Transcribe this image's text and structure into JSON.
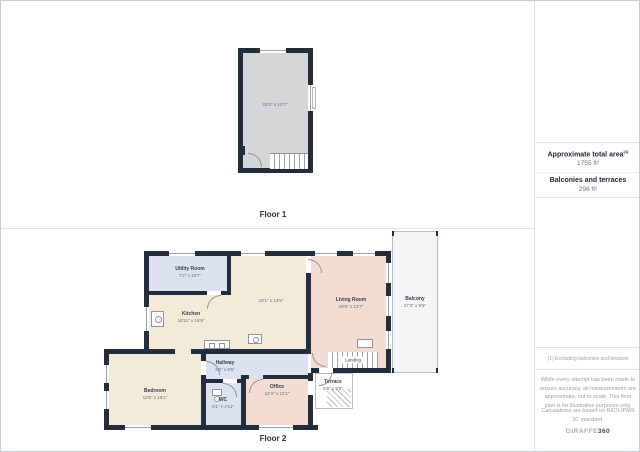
{
  "floor1": {
    "label": "Floor 1",
    "room_dims": "23'0\" x 12'7\""
  },
  "floor2": {
    "label": "Floor 2",
    "rooms": {
      "utility": {
        "name": "Utility Room",
        "dims": "7'2\" x 15'7\""
      },
      "kitchen": {
        "name": "Kitchen",
        "dims": "18'11\" x 16'9\""
      },
      "dining": {
        "dims": "18'1\" x 13'5\""
      },
      "living": {
        "name": "Living Room",
        "dims": "19'8\" x 13'7\""
      },
      "balcony": {
        "name": "Balcony",
        "dims": "27'3\" x 9'5\""
      },
      "hallway": {
        "name": "Hallway",
        "dims": "3'2\" x 8'5\""
      },
      "bedroom": {
        "name": "Bedroom",
        "dims": "12'6\" x 18'1\""
      },
      "wc": {
        "name": "WC",
        "dims": "8'1\" x 4'11\""
      },
      "office": {
        "name": "Office",
        "dims": "12'4\" x 12'1\""
      },
      "terrace": {
        "name": "Terrace",
        "dims": "6'8\" x 5'6\""
      },
      "landing": {
        "name": "Landing"
      }
    }
  },
  "sidebar": {
    "total_area_label": "Approximate total area",
    "total_area_sup": "(1)",
    "total_area_value": "1755 ft²",
    "balconies_label": "Balconies and terraces",
    "balconies_value": "296 ft²",
    "footnote": "(1) Excluding balconies and terraces",
    "disclaimer": "While every attempt has been made to ensure accuracy, all measurements are approximate, not to scale. This floor plan is for illustrative purposes only.",
    "standard": "Calculations are based on RICS IPMS 3C standard.",
    "logo_prefix": "GIRAFFE",
    "logo_suffix": "360"
  },
  "colors": {
    "wall": "#242d3c",
    "floor1_room": "#d5d6d8",
    "blue_room": "#dce2f0",
    "beige_room": "#f3ead9",
    "pink_room": "#f3dcd2",
    "outdoor": "#f4f5f7"
  }
}
